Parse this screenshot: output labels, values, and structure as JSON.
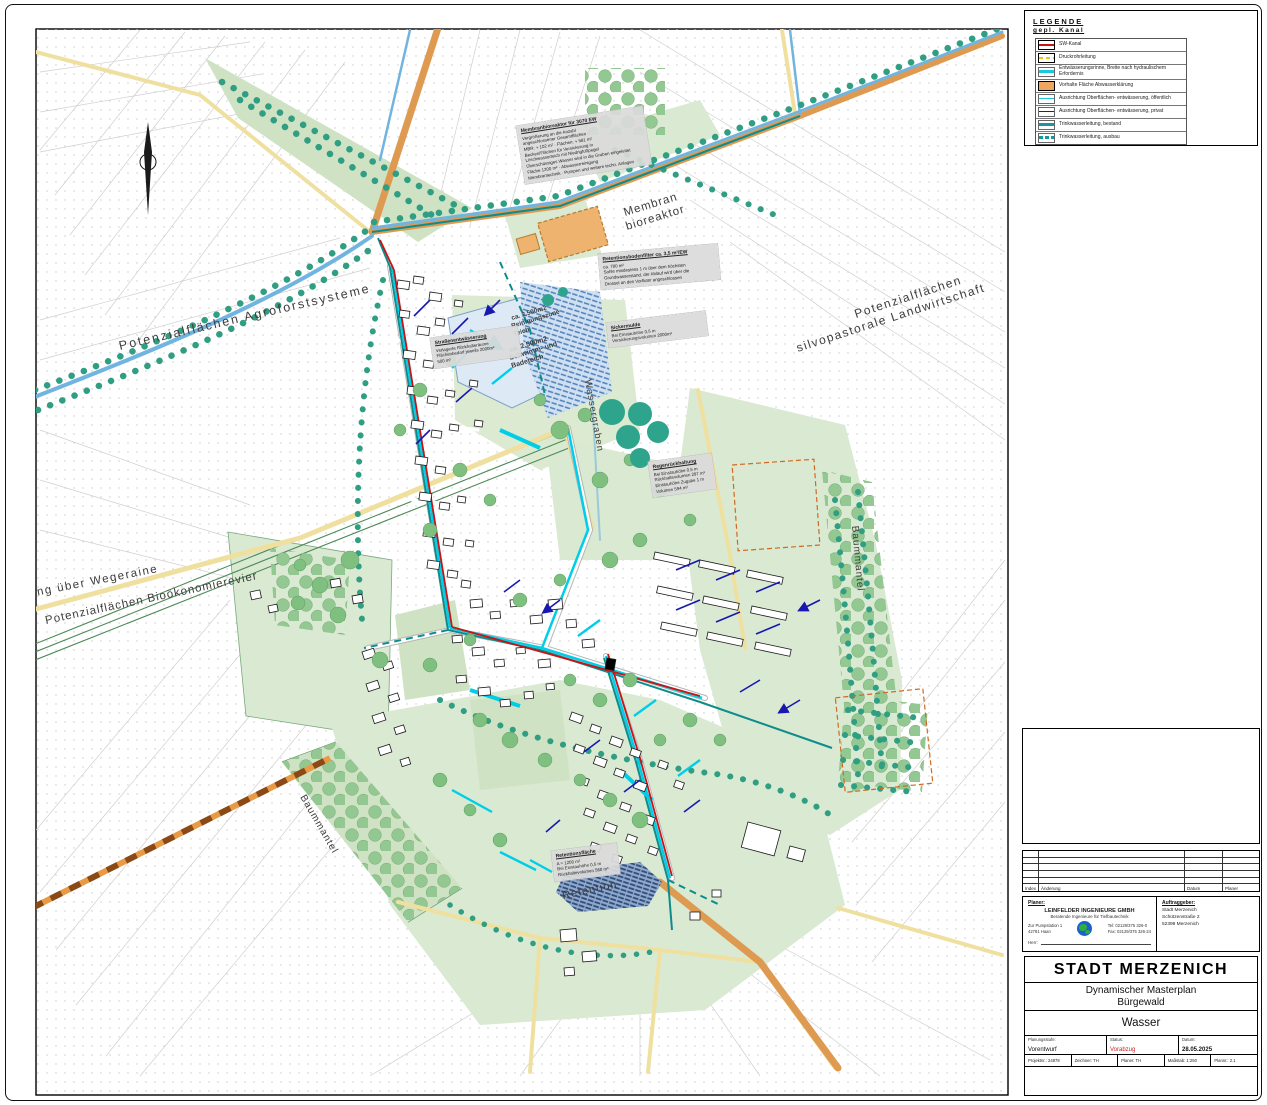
{
  "legend": {
    "title": "LEGENDE",
    "subtitle": "gepl. Kanal",
    "items": [
      {
        "symbol": "sw-kanal-line",
        "label": "SW-Kanal"
      },
      {
        "symbol": "druckrohr-dashed",
        "label": "Druckrohrleitung"
      },
      {
        "symbol": "rinne-cyan",
        "label": "Entwässerungsrinne, Breite nach hydraulischem Erfordernis"
      },
      {
        "symbol": "vorhalte-orange",
        "label": "Vorhalte Fläche Abwasserklärung"
      },
      {
        "symbol": "oberflaeche-oeffentlich-cyan",
        "label": "Ausrichtung Oberflächen- entwässerung, öffentlich"
      },
      {
        "symbol": "oberflaeche-privat-blau",
        "label": "Ausrichtung Oberflächen- entwässerung, privat"
      },
      {
        "symbol": "trinkwasser-bestand",
        "label": "Trinkwasserleitung, bestand"
      },
      {
        "symbol": "trinkwasser-ausbau",
        "label": "Trinkwasserleitung, ausbau"
      }
    ]
  },
  "revision_table": {
    "col_index": "Index",
    "col_change": "Änderung",
    "col_date": "Datum",
    "col_planner": "Planer"
  },
  "planner_block": {
    "label": "Planer:",
    "company": "LEINFELDER INGENIEURE GMBH",
    "tagline": "Beratende Ingenieure für Tiefbautechnik",
    "address1": "Zur Pumpstation 1",
    "address2": "42781 Haan",
    "tel": "Tel: 02129/375 326-0",
    "fax": "Fax: 02129/375 326-24",
    "contact_label": "Herr:"
  },
  "client_block": {
    "label": "Auftraggeber:",
    "line1": "Stadt Merzenich",
    "line2": "Schützenstraße 2",
    "line3": "52399 Merzenich"
  },
  "title_block": {
    "city": "STADT MERZENICH",
    "project_line1": "Dynamischer Masterplan",
    "project_line2": "Bürgewald",
    "sheet": "Wasser",
    "planungsstufe_label": "Planungsstufe:",
    "planungsstufe": "Vorentwurf",
    "status_label": "Status:",
    "status": "Vorabzug",
    "datum_label": "Datum:",
    "datum": "28.05.2025",
    "projekt": "Projektnr.: 24878",
    "zeichner": "Zeichner: TH",
    "planer": "Planer: TH",
    "massstab": "Maßstab: 1:250",
    "plannr": "Plannr.: 2.1",
    "status_color": "#cc2222"
  },
  "colors": {
    "sw_kanal": "#cc1111",
    "druckrohr": "#e8c520",
    "rinne": "#19c9e2",
    "vorhalte": "#eda75f",
    "privat": "#1818b0",
    "trinkwasser": "#15999c",
    "green_area": "#d9e9d2",
    "tree_teal": "#2f9e82",
    "road_tan": "#de9a50",
    "road_yellow": "#f0e0a0",
    "stream_blue": "#72b4e0"
  },
  "map": {
    "labels": {
      "agro": "Potenzialflächen  Agroforstsysteme",
      "silvo1": "Potenzialflächen",
      "silvo2": "silvopastorale  Landwirtschaft",
      "membran1": "Membran",
      "membran2": "bioreaktor",
      "wegeraine": "ung über Wegeraine",
      "biooekonomie": "Potenzialflächen Bioökonomierevier",
      "wassergraben": "Wassergraben",
      "baummantel_r": "Baummantel",
      "baummantel_l": "Baummantel",
      "retention": "Retention",
      "teich1_l1": "ca. 2.500m2",
      "teich1_l2": "Reinigungszone",
      "teich1_l3": "Teich",
      "teich2_l1": "ca. 2.500m2",
      "teich2_l2": "Schwimm- und",
      "teich2_l3": "Badeteich"
    },
    "annotations": [
      {
        "title": "Membranbioreaktor für 3070 EW",
        "lines": [
          "Vergrößerung an die Anzahl",
          "angeschlossener Gesamtflächen",
          "MBR: + 102 m²  ·  Flächen: + 581 m²",
          "Becken/Flächen für Versickerung in",
          "Löschwasserteich mit Niedrigfußpegel",
          "Überschüssiges Wasser wird in die Gruben eingeleitet",
          "Fläche 1200 m² · Abwasserreinigung",
          "Membrantechnik · Pumpen und weitere techn. Anlagen"
        ]
      },
      {
        "title": "Retentionsbodenfilter ca. 3,5 m²/EW",
        "lines": [
          "ca. 780 m²",
          "Sohle mindestens 1 m über dem höchsten",
          "Grundwasserstand, der Ablauf wird über die",
          "Drossel an den Vorfluter angeschlossen"
        ]
      },
      {
        "title": "Sickermulde",
        "lines": [
          "Bei Einstauhöhe 0,5 m",
          "Versickerungsvolumen 2000m³"
        ]
      },
      {
        "title": "Straßenentwässerung",
        "lines": [
          "Verlagerte Rückhalteräume",
          "Flächenbedarf jeweils 2000m²",
          "500 m²"
        ]
      },
      {
        "title": "Regenrückhaltung",
        "lines": [
          "Bei Einstauhöhe 0,5 m",
          "Rückhaltevolumen 297 m³",
          "Einstauhöhe Zugabe 1 m",
          "Volumen 594 m³"
        ]
      },
      {
        "title": "Retentionsfläche",
        "lines": [
          "A = 1200 m²",
          "Bei Einstauhöhe 0,5 m",
          "Rückhaltevolumen 560 m³"
        ]
      }
    ]
  }
}
